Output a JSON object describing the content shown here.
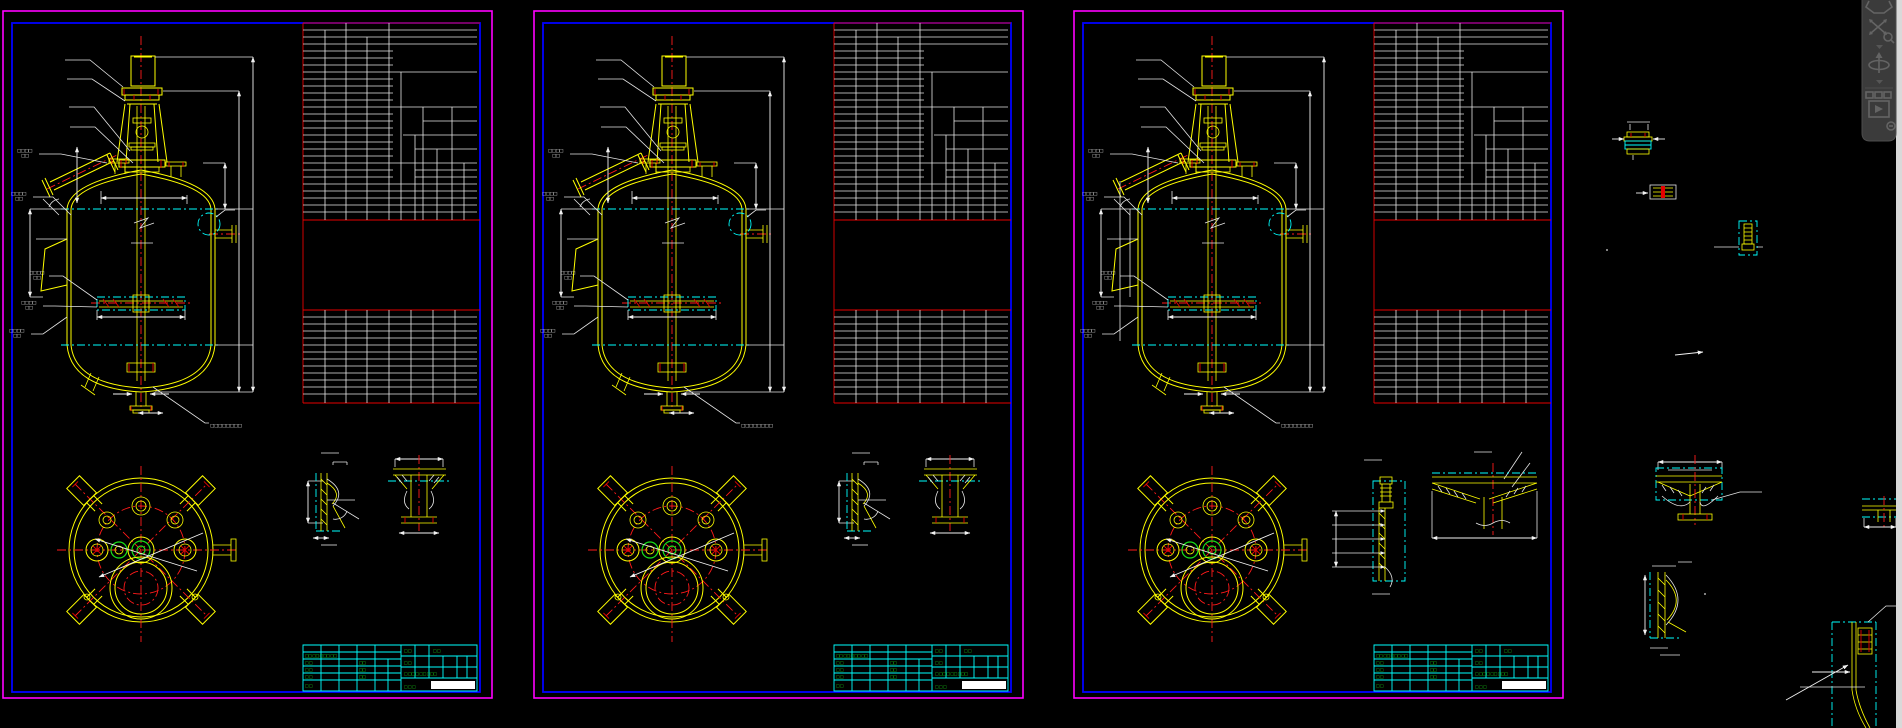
{
  "window": {
    "type": "cad-drawing-canvas",
    "background": "#000000",
    "right_edge_strip_color": "#d9d9d9"
  },
  "colors": {
    "sheet_border_outer": "#ff00ff",
    "sheet_border_inner": "#0000ff",
    "table_border": "#e60000",
    "table_grid": "#e6e6e6",
    "geometry": "#ffff00",
    "centerline": "#ff1a1a",
    "phantom_line": "#00ffff",
    "title_text": "#19e019",
    "dimension": "#f2f2f2",
    "navbar_bg": "#3b3b3b",
    "navbar_icon": "#646464"
  },
  "sheets": [
    {
      "name": "drawing-sheet-1"
    },
    {
      "name": "drawing-sheet-2"
    },
    {
      "name": "drawing-sheet-3"
    }
  ],
  "annotation": {
    "leader_labels": [
      [
        "□□□□",
        "□□"
      ],
      [
        "□□□□",
        "□□"
      ],
      [
        "□□□□",
        "□□"
      ],
      [
        "□□□□",
        "□□"
      ],
      [
        "□□□□",
        "□□"
      ]
    ],
    "bottom_note": "□□□□□□□□"
  },
  "title_block": {
    "cells": [
      "□□ □□ □□□ □□",
      "□ □",
      "□□",
      "□ □",
      "□□",
      "□ □",
      "□□",
      "□ □",
      "□ □",
      "□ □",
      "□ □",
      "□ □□ □ □□ □□□",
      "□  □  □"
    ],
    "signature_bar_color": "#ffffff"
  },
  "navbar": {
    "icons": [
      {
        "name": "steering-wheel-icon"
      },
      {
        "name": "pan-zoom-icon"
      },
      {
        "name": "dropdown-caret-icon"
      },
      {
        "name": "orbit-icon"
      },
      {
        "name": "dropdown-caret-icon"
      },
      {
        "name": "show-motion-icon"
      },
      {
        "name": "minimize-navbar-icon"
      }
    ]
  }
}
